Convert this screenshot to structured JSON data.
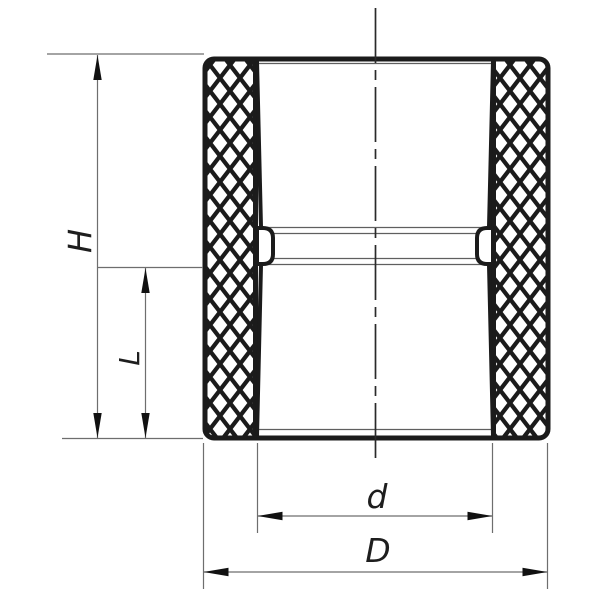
{
  "drawing": {
    "kind": "pipe-coupling-section-drawing",
    "labels": {
      "height": "H",
      "socket_depth": "L",
      "inner_diameter": "d",
      "outer_diameter": "D"
    },
    "colors": {
      "background": "#ffffff",
      "bold_line": "#1b1b1b",
      "thin_line": "#6e6e6e",
      "centerline": "#2a2a2a",
      "text": "#1e1e1e"
    }
  }
}
